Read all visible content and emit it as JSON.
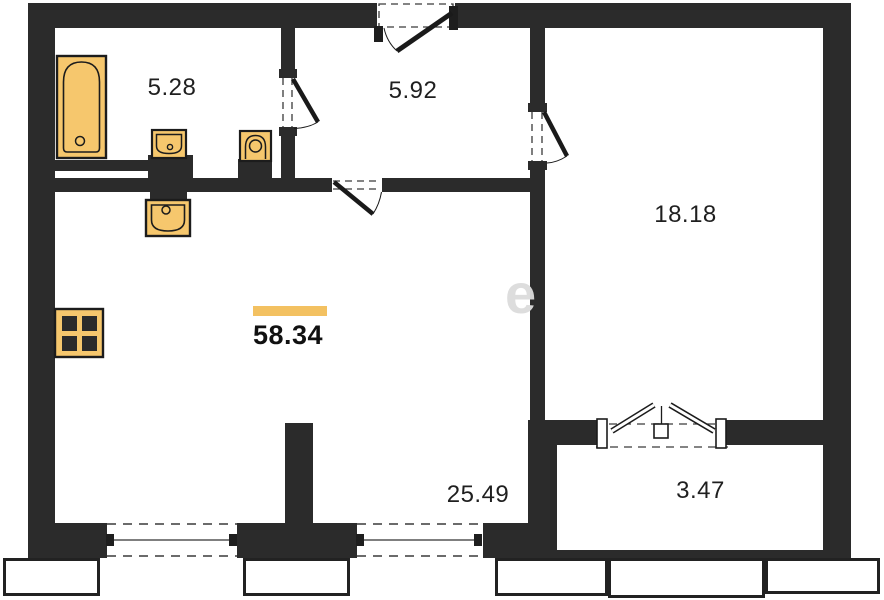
{
  "plan_title": "apartment-floor-plan",
  "rooms": [
    {
      "name": "bathroom",
      "area": "5.28"
    },
    {
      "name": "hallway",
      "area": "5.92"
    },
    {
      "name": "bedroom",
      "area": "18.18"
    },
    {
      "name": "total-area",
      "area": "58.34"
    },
    {
      "name": "living-kitchen",
      "area": "25.49"
    },
    {
      "name": "balcony",
      "area": "3.47"
    }
  ],
  "watermark": "e",
  "colors": {
    "wall": "#2b2b2b",
    "fixture_fill": "#f6c76d",
    "fixture_outline": "#1c1c1c",
    "highlight_bar": "#f3c161"
  },
  "fixtures": [
    {
      "name": "bathtub"
    },
    {
      "name": "bathroom-sink"
    },
    {
      "name": "toilet"
    },
    {
      "name": "kitchen-sink"
    },
    {
      "name": "stove"
    }
  ],
  "openings": [
    {
      "name": "entrance-door"
    },
    {
      "name": "bathroom-door"
    },
    {
      "name": "living-room-door"
    },
    {
      "name": "bedroom-door"
    },
    {
      "name": "balcony-french-door"
    },
    {
      "name": "window-1"
    },
    {
      "name": "window-2"
    }
  ]
}
